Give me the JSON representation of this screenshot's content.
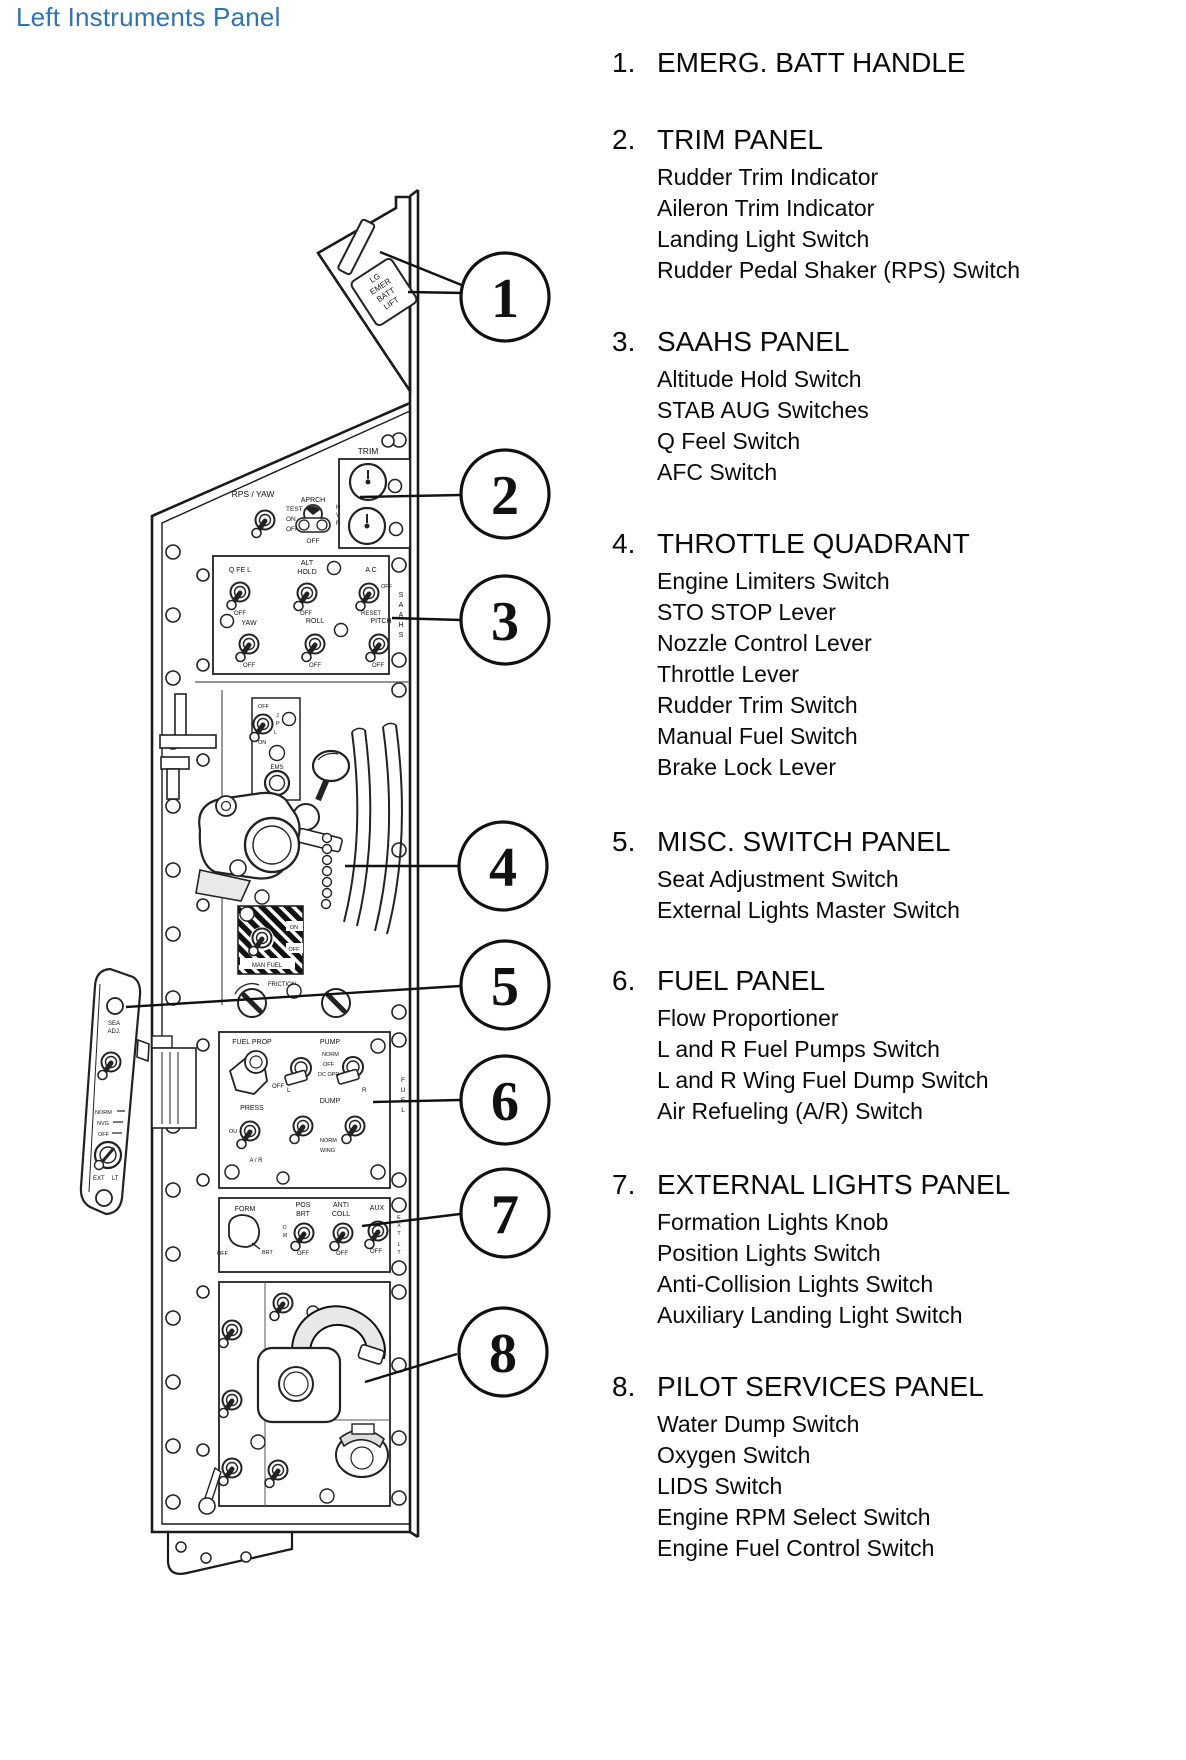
{
  "page": {
    "title": "Left Instruments Panel",
    "title_color": "#2E74B5"
  },
  "legend": {
    "items": [
      {
        "num": "1.",
        "heading": "EMERG. BATT HANDLE",
        "subs": []
      },
      {
        "num": "2.",
        "heading": "TRIM PANEL",
        "subs": [
          "Rudder Trim Indicator",
          "Aileron Trim Indicator",
          "Landing Light Switch",
          "Rudder Pedal Shaker (RPS) Switch"
        ]
      },
      {
        "num": "3.",
        "heading": "SAAHS PANEL",
        "subs": [
          "Altitude Hold Switch",
          "STAB AUG Switches",
          "Q Feel Switch",
          "AFC Switch"
        ]
      },
      {
        "num": "4.",
        "heading": "THROTTLE QUADRANT",
        "subs": [
          "Engine Limiters Switch",
          "STO STOP Lever",
          "Nozzle Control Lever",
          "Throttle Lever",
          "Rudder Trim Switch",
          "Manual Fuel Switch",
          "Brake Lock Lever"
        ]
      },
      {
        "num": "5.",
        "heading": "MISC. SWITCH PANEL",
        "subs": [
          "Seat Adjustment Switch",
          "External Lights Master Switch"
        ]
      },
      {
        "num": "6.",
        "heading": "FUEL PANEL",
        "subs": [
          "Flow Proportioner",
          "L and R Fuel Pumps Switch",
          "L and R Wing Fuel Dump Switch",
          "Air Refueling (A/R) Switch"
        ]
      },
      {
        "num": "7.",
        "heading": "EXTERNAL LIGHTS PANEL",
        "subs": [
          "Formation Lights Knob",
          "Position Lights Switch",
          "Anti-Collision Lights Switch",
          "Auxiliary Landing Light Switch"
        ]
      },
      {
        "num": "8.",
        "heading": "PILOT SERVICES PANEL",
        "subs": [
          "Water Dump Switch",
          "Oxygen Switch",
          "LIDS Switch",
          "Engine RPM Select Switch",
          "Engine Fuel Control Switch"
        ]
      }
    ]
  },
  "diagram": {
    "callouts": [
      "1",
      "2",
      "3",
      "4",
      "5",
      "6",
      "7",
      "8"
    ],
    "labels": {
      "handle0": "LG",
      "handle1": "EMER",
      "handle2": "BATT",
      "handle3": "LIFT",
      "trim": "TRIM",
      "rps_yaw": "RPS / YAW",
      "test": "TEST",
      "on": "ON",
      "off": "OFF",
      "aprch": "APRCH",
      "h": "H",
      "v": "V",
      "r": "R",
      "q_feel": "Q FE L",
      "alt": "ALT",
      "hold": "HOLD",
      "ac": "A C",
      "reset": "RESET",
      "yaw": "YAW",
      "roll": "ROLL",
      "pitch": "PITCH",
      "s": "S",
      "a": "A",
      "j": "J",
      "p": "P",
      "l": "L",
      "ems": "EMS",
      "man_fuel": "MAN FUEL",
      "friction": "FRICTION",
      "sea": "SEA",
      "adj": "ADJ.",
      "norm": "NORM",
      "nvg": "NVG",
      "ext": "EXT",
      "lt": "LT",
      "fuel_prop": "FUEL PROP",
      "pump": "PUMP",
      "dc_opr": "DC OPR",
      "dump": "DUMP",
      "press": "PRESS",
      "ar": "A / R",
      "wing": "WING",
      "ou": "OU",
      "f": "F",
      "u": "U",
      "e": "E",
      "form": "FORM",
      "brt": "BRT",
      "pos": "POS",
      "anti": "ANTI",
      "coll": "COLL",
      "aux": "AUX",
      "d": "D",
      "m": "M",
      "x": "X",
      "t": "T"
    }
  }
}
